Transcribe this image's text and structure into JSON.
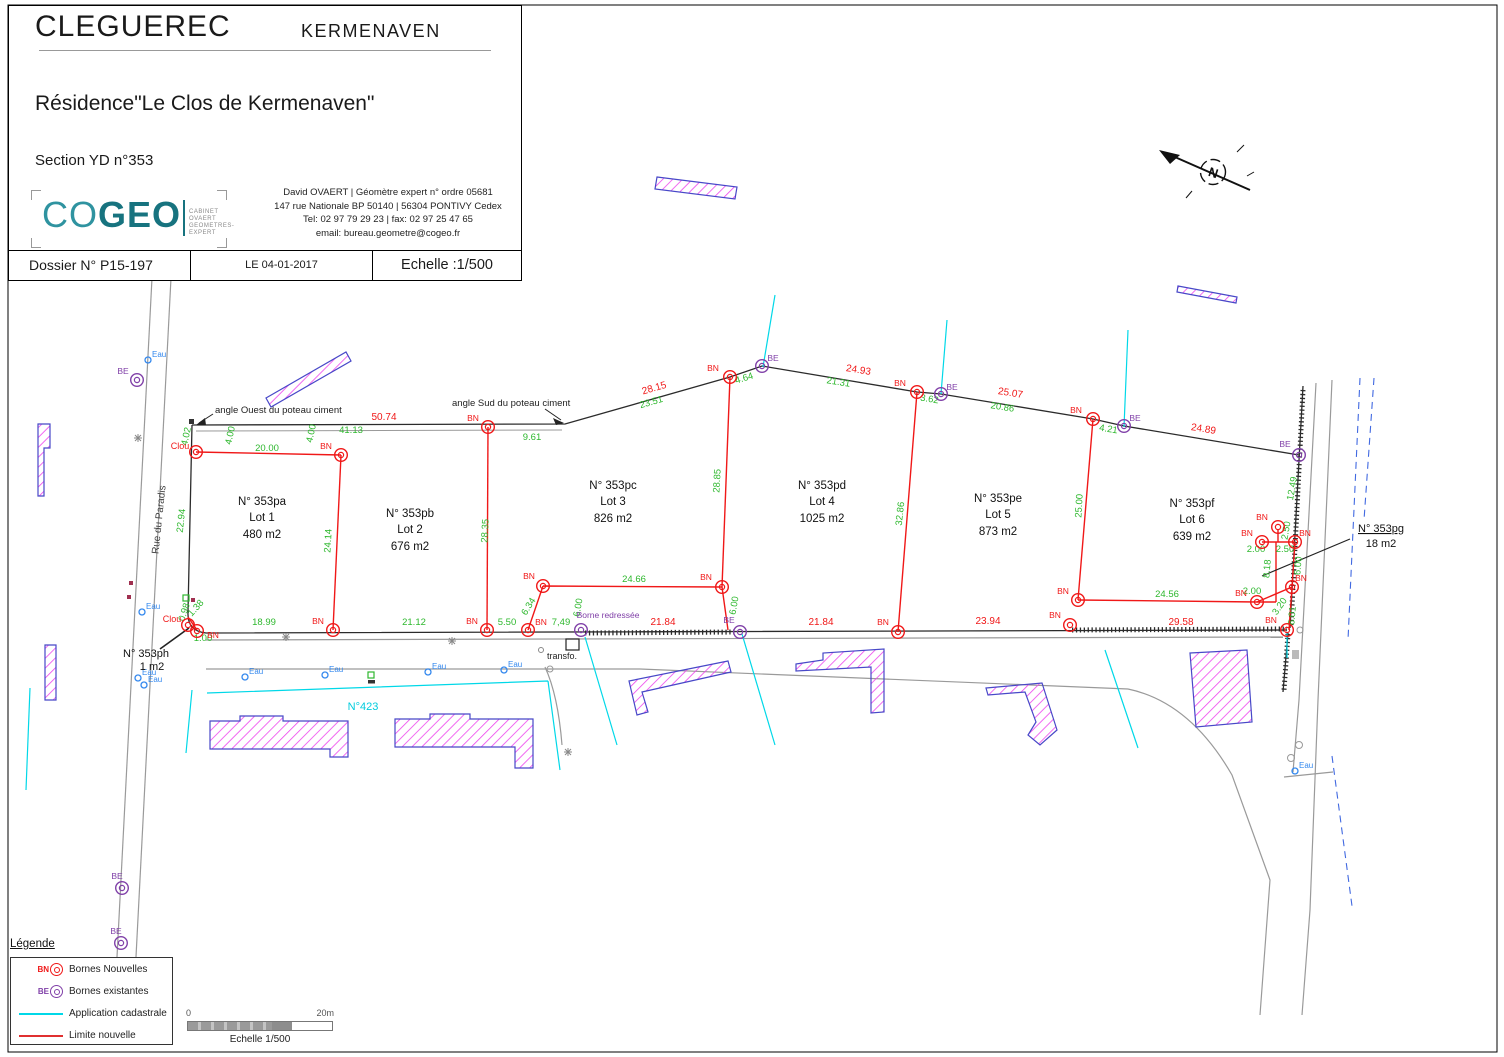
{
  "title_block": {
    "commune": "CLEGUEREC",
    "lieu_dit": "KERMENAVEN",
    "residence": "Résidence\"Le Clos de Kermenaven\"",
    "section": "Section YD n°353",
    "logo": {
      "part1": "CO",
      "part2": "GEO",
      "sub1": "CABINET OVAERT",
      "sub2": "GEOMETRES-EXPERT"
    },
    "contact_line1": "David OVAERT | Géomètre expert n° ordre 05681",
    "contact_line2": "147 rue Nationale BP 50140 | 56304 PONTIVY Cedex",
    "contact_line3": "Tel: 02 97 79 29 23 | fax: 02 97 25 47 65",
    "contact_line4": "email: bureau.geometre@cogeo.fr",
    "dossier": "Dossier N° P15-197",
    "date": "LE 04-01-2017",
    "echelle": "Echelle :1/500"
  },
  "legend": {
    "title": "Légende",
    "rows": [
      {
        "sym": "BN",
        "label": "Bornes Nouvelles"
      },
      {
        "sym": "BE",
        "label": "Bornes existantes"
      },
      {
        "sym": "",
        "label": "Application cadastrale"
      },
      {
        "sym": "",
        "label": "Limite nouvelle"
      }
    ]
  },
  "scalebar": {
    "zero": "0",
    "max": "20m",
    "label": "Echelle 1/500"
  },
  "map": {
    "colors": {
      "red": "#f01818",
      "green": "#2eb82e",
      "purple": "#8040a8",
      "cyan": "#00d8e8",
      "blue": "#3388ee",
      "teal": "#17737f",
      "magenta": "#ee44ee",
      "violet": "#4848c8"
    },
    "symbols": {
      "bn": "BN",
      "be": "BE",
      "eau": "Eau",
      "clou": "Clou"
    },
    "lots": [
      {
        "parcel": "N° 353pa",
        "lot": "Lot 1",
        "area": "480 m2",
        "x": 262,
        "y": 505
      },
      {
        "parcel": "N° 353pb",
        "lot": "Lot 2",
        "area": "676 m2",
        "x": 410,
        "y": 517
      },
      {
        "parcel": "N° 353pc",
        "lot": "Lot 3",
        "area": "826 m2",
        "x": 613,
        "y": 489
      },
      {
        "parcel": "N° 353pd",
        "lot": "Lot 4",
        "area": "1025 m2",
        "x": 822,
        "y": 489
      },
      {
        "parcel": "N° 353pe",
        "lot": "Lot 5",
        "area": "873 m2",
        "x": 998,
        "y": 502
      },
      {
        "parcel": "N° 353pf",
        "lot": "Lot 6",
        "area": "639 m2",
        "x": 1192,
        "y": 507
      }
    ],
    "green_dims": [
      {
        "t": "4.02",
        "x": 189,
        "y": 437,
        "r": -78
      },
      {
        "t": "4.00",
        "x": 233,
        "y": 436,
        "r": -78
      },
      {
        "t": "20.00",
        "x": 267,
        "y": 451
      },
      {
        "t": "41.13",
        "x": 351,
        "y": 433
      },
      {
        "t": "4.00",
        "x": 314,
        "y": 434,
        "r": -78
      },
      {
        "t": "9.61",
        "x": 532,
        "y": 440
      },
      {
        "t": "23.51",
        "x": 652,
        "y": 405,
        "r": -16
      },
      {
        "t": "4.64",
        "x": 745,
        "y": 381,
        "r": -17
      },
      {
        "t": "21.31",
        "x": 838,
        "y": 385,
        "r": 9
      },
      {
        "t": "3.62",
        "x": 929,
        "y": 402,
        "r": 9
      },
      {
        "t": "20.86",
        "x": 1002,
        "y": 410,
        "r": 9
      },
      {
        "t": "4.21",
        "x": 1108,
        "y": 432,
        "r": 9
      },
      {
        "t": "12.49",
        "x": 1295,
        "y": 489,
        "r": -80
      },
      {
        "t": "22.94",
        "x": 184,
        "y": 521,
        "r": -84
      },
      {
        "t": "24.14",
        "x": 331,
        "y": 541,
        "r": -87
      },
      {
        "t": "28.35",
        "x": 488,
        "y": 531,
        "r": -87
      },
      {
        "t": "28.85",
        "x": 720,
        "y": 481,
        "r": -87
      },
      {
        "t": "32.86",
        "x": 903,
        "y": 514,
        "r": -84
      },
      {
        "t": "25.00",
        "x": 1082,
        "y": 506,
        "r": -87
      },
      {
        "t": "18.99",
        "x": 264,
        "y": 625
      },
      {
        "t": "21.12",
        "x": 414,
        "y": 625
      },
      {
        "t": "5.50",
        "x": 507,
        "y": 625
      },
      {
        "t": "7,49",
        "x": 561,
        "y": 625
      },
      {
        "t": "6.34",
        "x": 531,
        "y": 608,
        "r": -58
      },
      {
        "t": "6.00",
        "x": 581,
        "y": 608,
        "r": -80
      },
      {
        "t": "24.66",
        "x": 634,
        "y": 582
      },
      {
        "t": "6.00",
        "x": 737,
        "y": 606,
        "r": -80
      },
      {
        "t": "24.56",
        "x": 1167,
        "y": 597
      },
      {
        "t": "2.00",
        "x": 1252,
        "y": 594
      },
      {
        "t": "2.50",
        "x": 1289,
        "y": 531,
        "r": -80
      },
      {
        "t": "2.00",
        "x": 1256,
        "y": 552
      },
      {
        "t": "2.50",
        "x": 1285,
        "y": 552
      },
      {
        "t": "8.18",
        "x": 1270,
        "y": 569,
        "r": -85
      },
      {
        "t": "6.00",
        "x": 1301,
        "y": 566,
        "r": -85
      },
      {
        "t": "3.20",
        "x": 1282,
        "y": 608,
        "r": -55
      },
      {
        "t": "6.01",
        "x": 1295,
        "y": 616,
        "r": -85
      },
      {
        "t": "1.00",
        "x": 203,
        "y": 641
      },
      {
        "t": "0.98",
        "x": 187,
        "y": 613,
        "r": -72
      },
      {
        "t": "1.38",
        "x": 198,
        "y": 610,
        "r": -48
      }
    ],
    "red_dims": [
      {
        "t": "50.74",
        "x": 384,
        "y": 420
      },
      {
        "t": "28.15",
        "x": 655,
        "y": 391,
        "r": -16
      },
      {
        "t": "24.93",
        "x": 858,
        "y": 373,
        "r": 9
      },
      {
        "t": "25.07",
        "x": 1010,
        "y": 396,
        "r": 9
      },
      {
        "t": "24.89",
        "x": 1203,
        "y": 432,
        "r": 9
      },
      {
        "t": "21.84",
        "x": 663,
        "y": 625
      },
      {
        "t": "21.84",
        "x": 821,
        "y": 625
      },
      {
        "t": "23.94",
        "x": 988,
        "y": 624
      },
      {
        "t": "29.58",
        "x": 1181,
        "y": 625
      }
    ],
    "bn_points": [
      {
        "x": 341,
        "y": 455,
        "lx": 326,
        "ly": 449
      },
      {
        "x": 488,
        "y": 427,
        "lx": 473,
        "ly": 421
      },
      {
        "x": 730,
        "y": 377,
        "lx": 713,
        "ly": 371
      },
      {
        "x": 917,
        "y": 392,
        "lx": 900,
        "ly": 386
      },
      {
        "x": 1093,
        "y": 419,
        "lx": 1076,
        "ly": 413
      },
      {
        "x": 333,
        "y": 630,
        "lx": 318,
        "ly": 624
      },
      {
        "x": 487,
        "y": 630,
        "lx": 472,
        "ly": 624
      },
      {
        "x": 528,
        "y": 630,
        "lx": 541,
        "ly": 625
      },
      {
        "x": 543,
        "y": 586,
        "lx": 529,
        "ly": 579
      },
      {
        "x": 722,
        "y": 587,
        "lx": 706,
        "ly": 580
      },
      {
        "x": 898,
        "y": 632,
        "lx": 883,
        "ly": 625
      },
      {
        "x": 1070,
        "y": 625,
        "lx": 1055,
        "ly": 618
      },
      {
        "x": 1287,
        "y": 630,
        "lx": 1271,
        "ly": 623
      },
      {
        "x": 1078,
        "y": 600,
        "lx": 1063,
        "ly": 594
      },
      {
        "x": 1257,
        "y": 602,
        "lx": 1241,
        "ly": 596
      },
      {
        "x": 1292,
        "y": 587,
        "lx": 1301,
        "ly": 581
      },
      {
        "x": 1278,
        "y": 527,
        "lx": 1262,
        "ly": 520
      },
      {
        "x": 1262,
        "y": 542,
        "lx": 1247,
        "ly": 536
      },
      {
        "x": 1295,
        "y": 542,
        "lx": 1305,
        "ly": 536
      },
      {
        "x": 197,
        "y": 631,
        "lx": 213,
        "ly": 638
      }
    ],
    "clou_points": [
      {
        "x": 196,
        "y": 452,
        "lx": 180,
        "ly": 449
      },
      {
        "x": 188,
        "y": 625,
        "lx": 172,
        "ly": 622
      }
    ],
    "be_points": [
      {
        "x": 137,
        "y": 380,
        "lx": 123,
        "ly": 374
      },
      {
        "x": 762,
        "y": 366,
        "lx": 773,
        "ly": 361
      },
      {
        "x": 941,
        "y": 394,
        "lx": 952,
        "ly": 390
      },
      {
        "x": 1124,
        "y": 426,
        "lx": 1135,
        "ly": 421
      },
      {
        "x": 1299,
        "y": 455,
        "lx": 1285,
        "ly": 447
      },
      {
        "x": 740,
        "y": 632,
        "lx": 729,
        "ly": 623
      },
      {
        "x": 122,
        "y": 888,
        "lx": 117,
        "ly": 879
      },
      {
        "x": 121,
        "y": 943,
        "lx": 116,
        "ly": 934
      }
    ],
    "borne_redressee": {
      "x": 581,
      "y": 630,
      "label": "Borne redressée",
      "lx": 608,
      "ly": 618
    },
    "eau_points": [
      {
        "x": 148,
        "y": 360
      },
      {
        "x": 142,
        "y": 612
      },
      {
        "x": 138,
        "y": 678
      },
      {
        "x": 144,
        "y": 685
      },
      {
        "x": 245,
        "y": 677
      },
      {
        "x": 325,
        "y": 675
      },
      {
        "x": 428,
        "y": 672
      },
      {
        "x": 504,
        "y": 670
      },
      {
        "x": 1295,
        "y": 771
      }
    ],
    "annotations": [
      {
        "t": "angle Ouest du poteau ciment",
        "x": 215,
        "y": 413,
        "a": "start",
        "s": 9.5,
        "c": "#222"
      },
      {
        "t": "angle Sud du poteau ciment",
        "x": 452,
        "y": 406,
        "a": "start",
        "s": 9.5,
        "c": "#222"
      },
      {
        "t": "Rue du Paradis",
        "x": 162,
        "y": 520,
        "s": 10,
        "c": "#444",
        "r": -84
      },
      {
        "t": "N°423",
        "x": 363,
        "y": 710,
        "s": 11,
        "c": "#00ccdd"
      },
      {
        "t": "transfo.",
        "x": 562,
        "y": 659,
        "s": 9,
        "c": "#222"
      },
      {
        "t": "N° 353pg",
        "x": 1381,
        "y": 532,
        "s": 11,
        "c": "#111",
        "u": true
      },
      {
        "t": "18 m2",
        "x": 1381,
        "y": 547,
        "s": 11,
        "c": "#111"
      },
      {
        "t": "N° 353ph",
        "x": 146,
        "y": 657,
        "s": 11,
        "c": "#111"
      },
      {
        "t": "1 m2",
        "x": 152,
        "y": 670,
        "s": 11,
        "c": "#111"
      },
      {
        "t": "N",
        "x": 1212,
        "y": 177,
        "s": 13,
        "c": "#111",
        "r": 18,
        "b": true
      }
    ]
  }
}
